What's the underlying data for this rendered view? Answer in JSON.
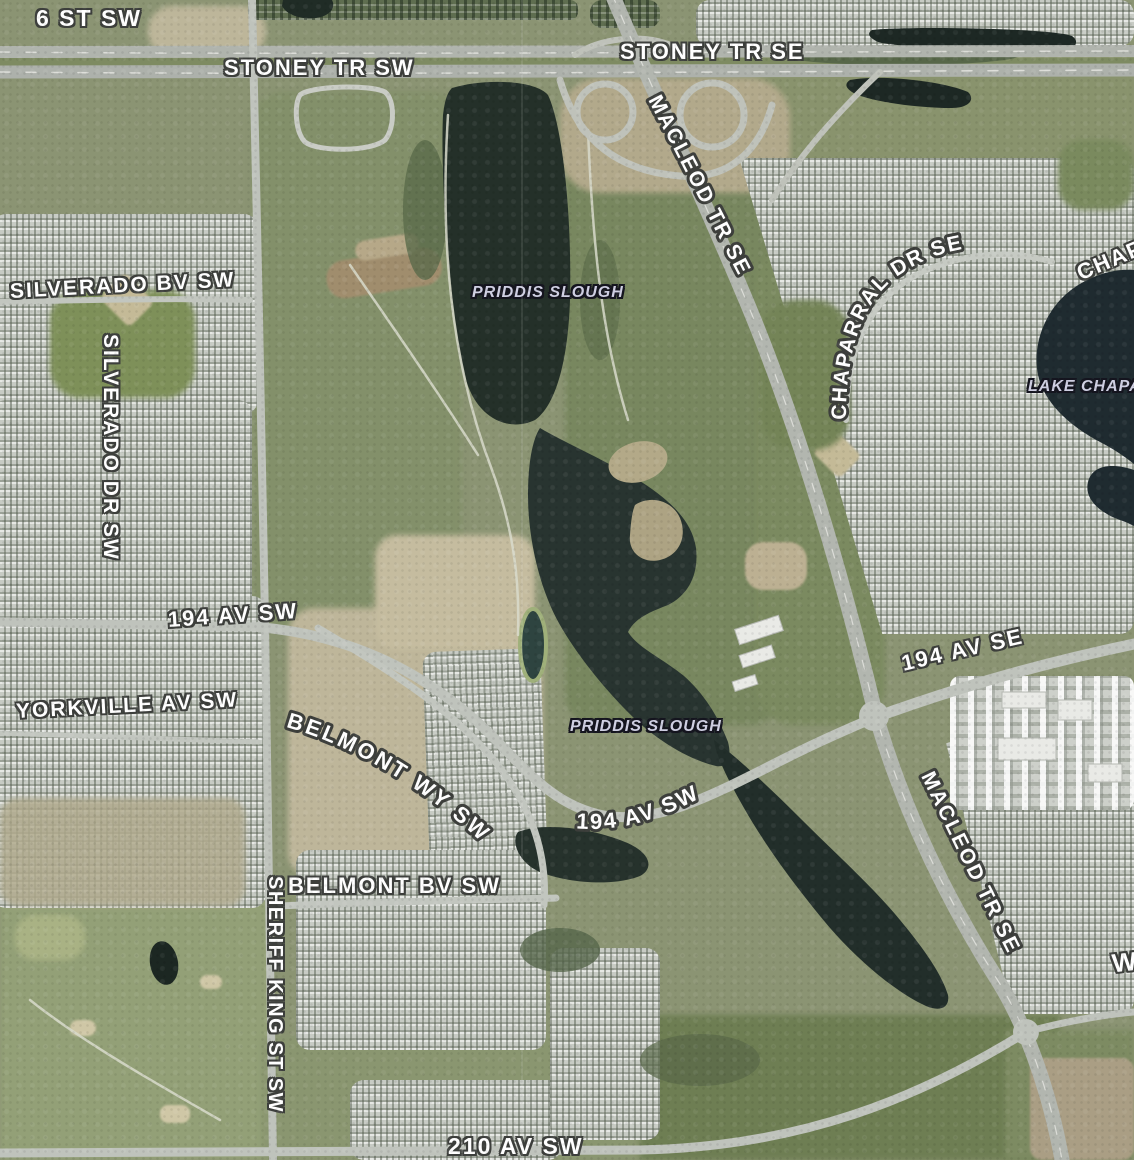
{
  "map": {
    "description": "satellite-aerial-map-view",
    "labels": {
      "road": [
        {
          "id": "6-st-sw",
          "text": "6 ST SW"
        },
        {
          "id": "stoney-tr-sw",
          "text": "STONEY TR SW"
        },
        {
          "id": "stoney-tr-se",
          "text": "STONEY TR SE"
        },
        {
          "id": "macleod-tr-se-north",
          "text": "MACLEOD TR SE"
        },
        {
          "id": "silverado-bv-sw",
          "text": "SILVERADO BV SW"
        },
        {
          "id": "silverado-dr-sw",
          "text": "SILVERADO DR SW"
        },
        {
          "id": "194-av-sw-west",
          "text": "194 AV SW"
        },
        {
          "id": "yorkville-av-sw",
          "text": "YORKVILLE AV SW"
        },
        {
          "id": "belmont-wy-sw",
          "text": "BELMONT WY SW"
        },
        {
          "id": "194-av-sw-center",
          "text": "194 AV SW"
        },
        {
          "id": "belmont-bv-sw",
          "text": "BELMONT BV SW"
        },
        {
          "id": "sheriff-king-st-sw",
          "text": "SHERIFF KING ST SW"
        },
        {
          "id": "210-av-sw",
          "text": "210 AV SW"
        },
        {
          "id": "194-av-se",
          "text": "194 AV SE"
        },
        {
          "id": "macleod-tr-se-south",
          "text": "MACLEOD TR SE"
        },
        {
          "id": "chaparral-dr-se",
          "text": "CHAPARRAL DR SE"
        },
        {
          "id": "chaparral-partial",
          "text": "CHAP"
        },
        {
          "id": "w-partial",
          "text": "W"
        }
      ],
      "water": [
        {
          "id": "priddis-slough-north",
          "text": "PRIDDIS SLOUGH"
        },
        {
          "id": "priddis-slough-south",
          "text": "PRIDDIS SLOUGH"
        },
        {
          "id": "lake-chaparral",
          "text": "LAKE CHAPA"
        }
      ]
    },
    "colors": {
      "field_green": "#83906a",
      "dark_green": "#6e7e53",
      "water_dark": "#243029",
      "lake_dark": "#1f2b30",
      "road_grey": "#b6bab3",
      "housing_grey": "#c7cbc4",
      "dirt_tan": "#beb69a",
      "label_fill": "#ffffff",
      "label_halo": "#3d3f3c",
      "water_label_fill": "#cfcfe2",
      "water_label_halo": "#15151f"
    }
  }
}
